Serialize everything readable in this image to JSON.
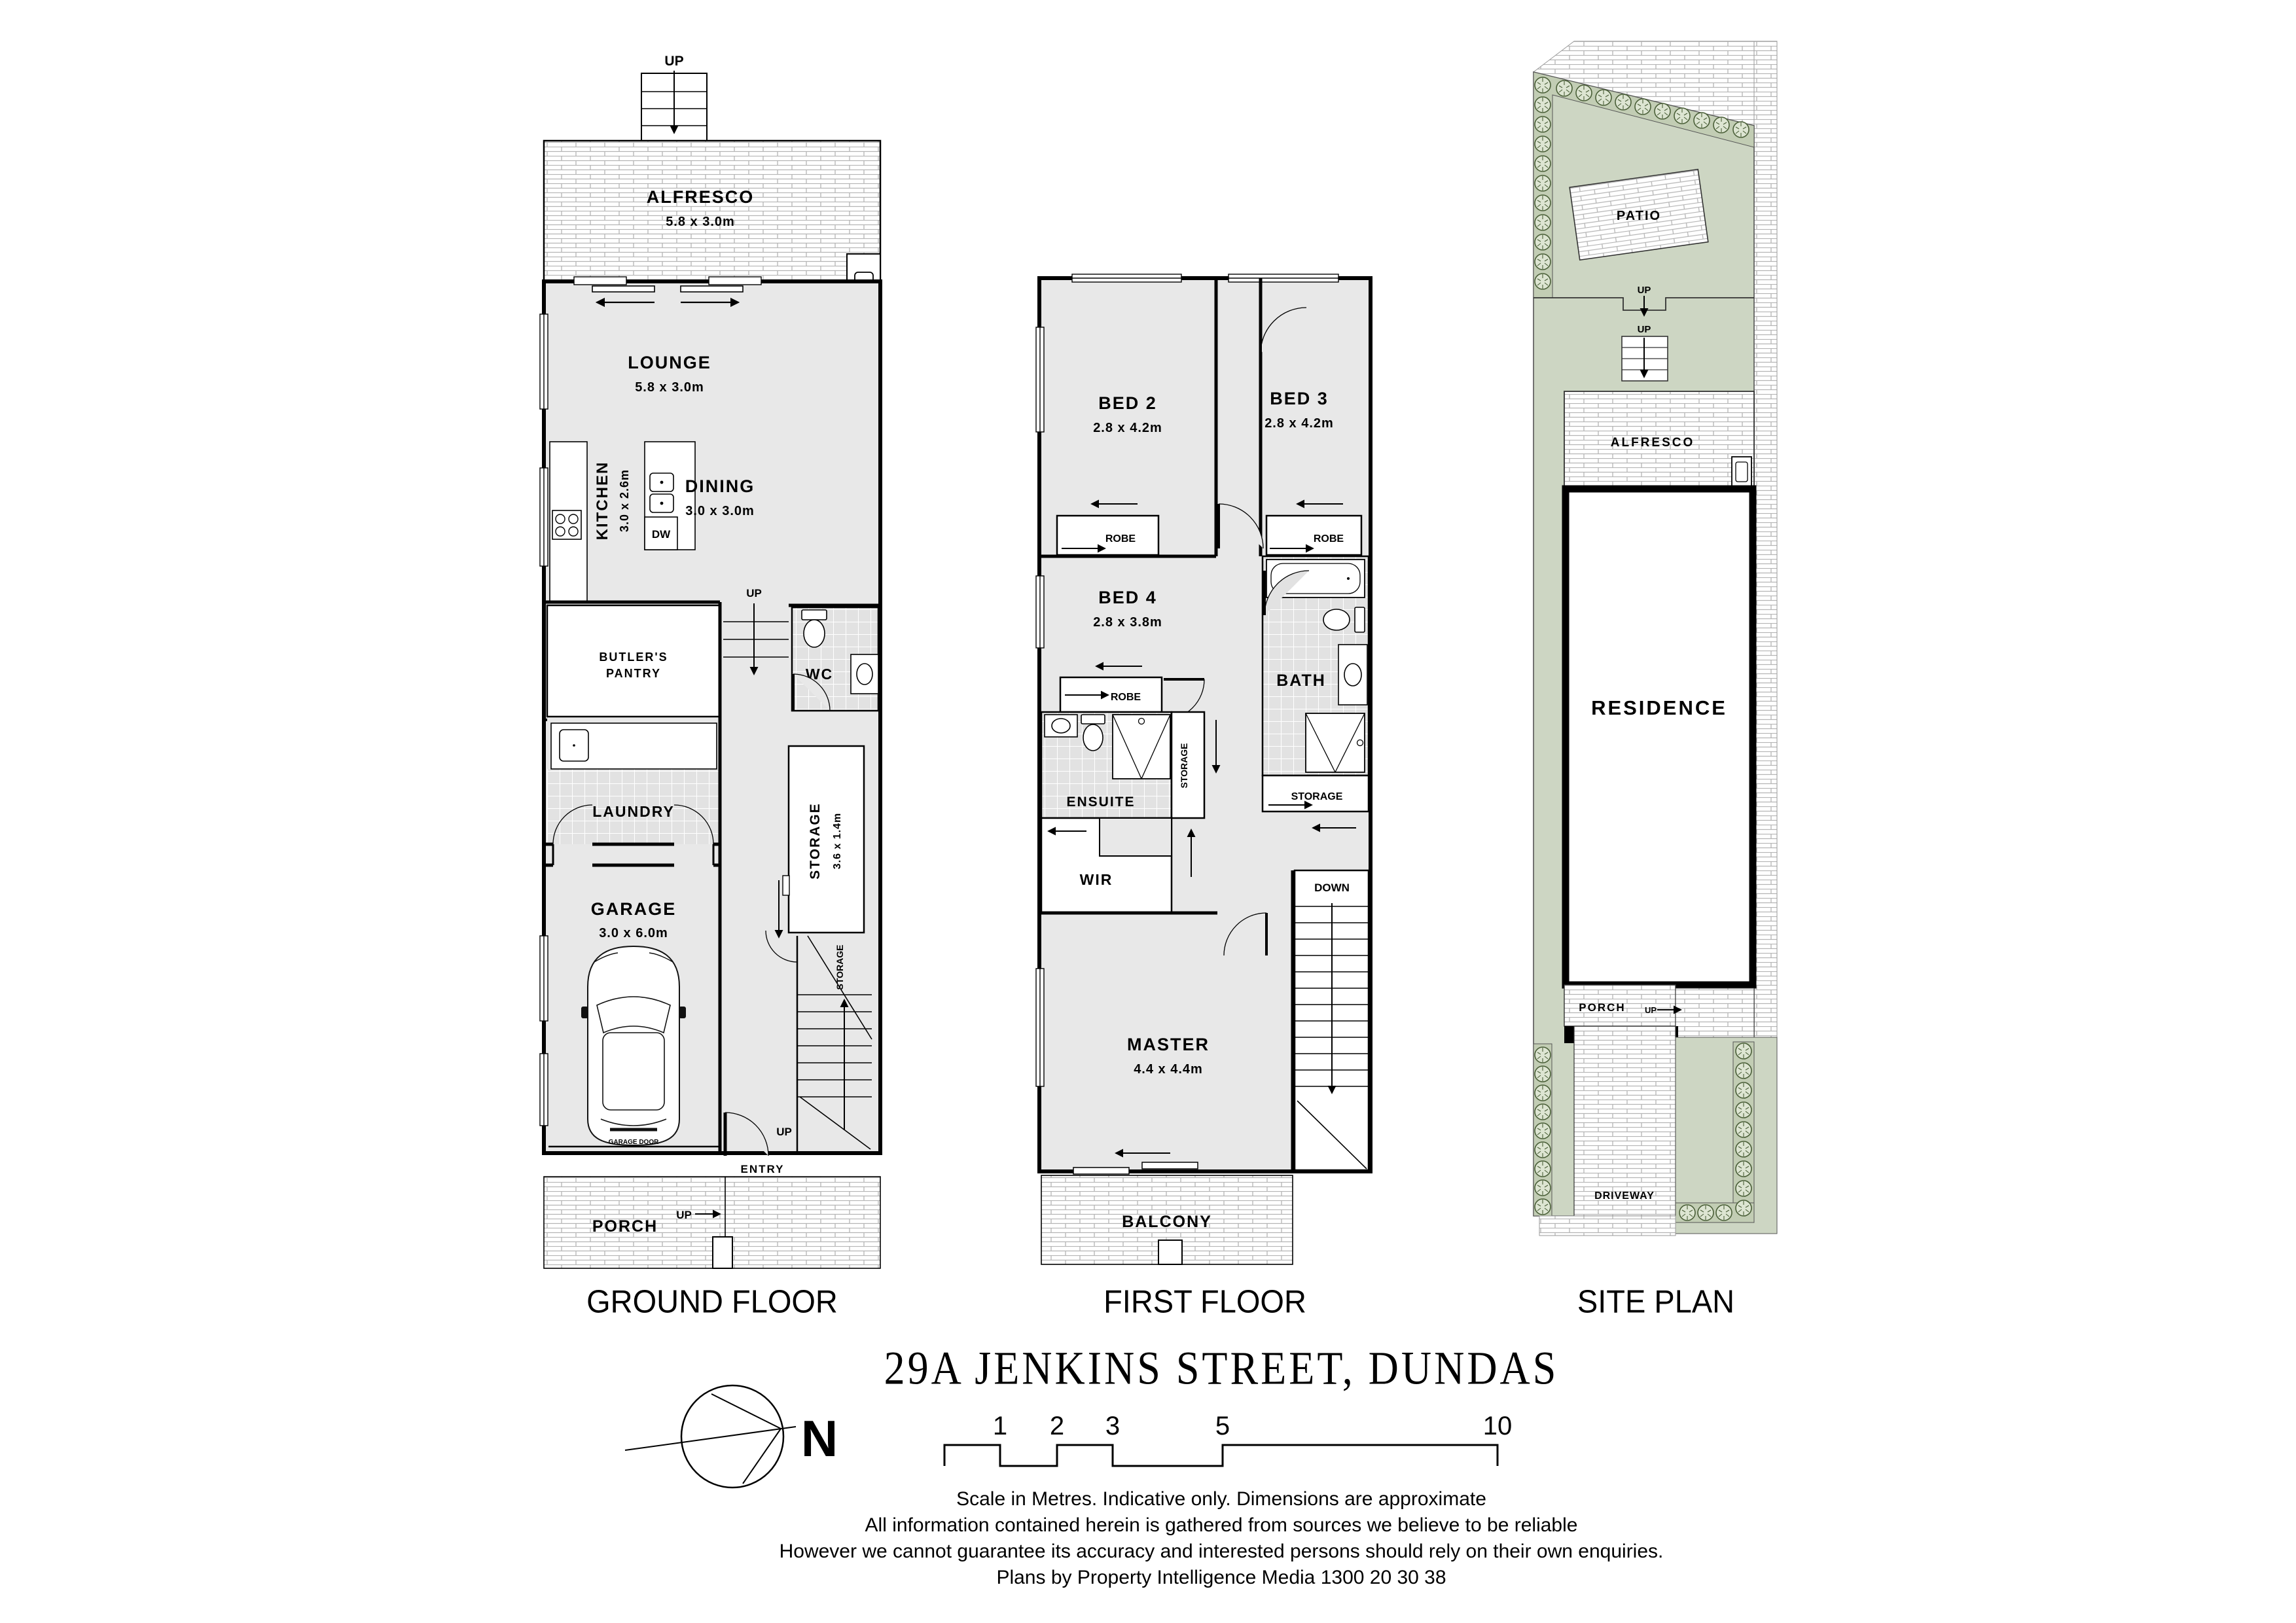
{
  "title": "29A JENKINS STREET, DUNDAS",
  "labels": {
    "up": "UP",
    "down": "DOWN",
    "robe": "ROBE",
    "storage": "STORAGE",
    "entry": "ENTRY",
    "porch": "PORCH",
    "wc": "WC",
    "laundry": "LAUNDRY",
    "dw": "DW",
    "fridge": "F",
    "garage_door": "GARAGE DOOR",
    "balcony": "BALCONY",
    "bath": "BATH",
    "ensuite": "ENSUITE",
    "wir": "WIR",
    "alfresco": "ALFRESCO",
    "butlers_line1": "BUTLER'S",
    "butlers_line2": "PANTRY",
    "patio": "PATIO",
    "residence": "RESIDENCE",
    "driveway": "DRIVEWAY",
    "north": "N"
  },
  "floors": {
    "ground": {
      "label": "GROUND FLOOR",
      "alfresco_dims": "5.8 x 3.0m",
      "lounge": "LOUNGE",
      "lounge_dims": "5.8 x 3.0m",
      "kitchen": "KITCHEN",
      "kitchen_dims": "3.0 x 2.6m",
      "dining": "DINING",
      "dining_dims": "3.0 x 3.0m",
      "storage_dims": "3.6 x 1.4m",
      "garage": "GARAGE",
      "garage_dims": "3.0 x 6.0m"
    },
    "first": {
      "label": "FIRST FLOOR",
      "bed2": "BED 2",
      "bed2_dims": "2.8 x 4.2m",
      "bed3": "BED 3",
      "bed3_dims": "2.8 x 4.2m",
      "bed4": "BED 4",
      "bed4_dims": "2.8 x 3.8m",
      "master": "MASTER",
      "master_dims": "4.4 x 4.4m"
    },
    "site": {
      "label": "SITE PLAN"
    }
  },
  "scale_bar": {
    "ticks": [
      "1",
      "2",
      "3",
      "5",
      "10"
    ]
  },
  "footer": {
    "line1": "Scale in Metres. Indicative only. Dimensions are approximate",
    "line2": "All information contained herein is gathered from sources we believe to be reliable",
    "line3": "However we cannot guarantee its accuracy and interested persons should rely on their own enquiries.",
    "line4": "Plans by Property Intelligence Media 1300 20 30 38"
  },
  "colors": {
    "site_green": "#cdd6c3",
    "hedge_band_green": "#c2cdb4",
    "hedge_stroke_green": "#4a5f38",
    "room_gray": "#e8e8e8",
    "tile_gray": "#e2e2e2",
    "wall_black": "#000000",
    "brick_line": "#b5b5b5"
  }
}
